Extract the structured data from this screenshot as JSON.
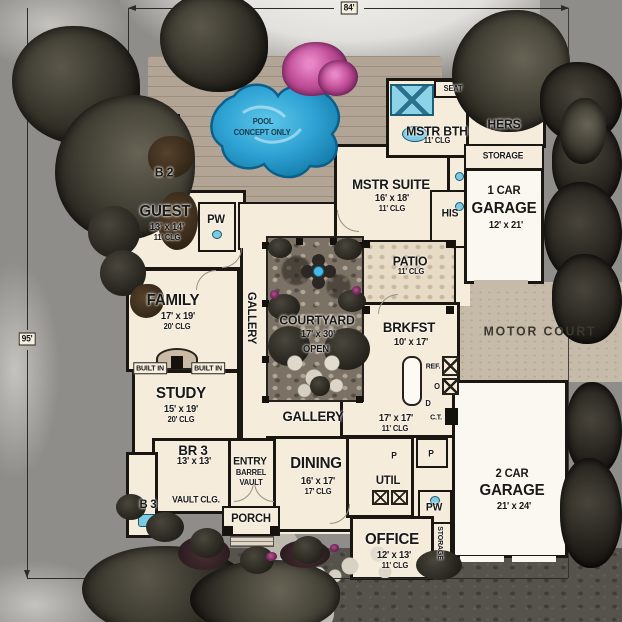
{
  "dims": {
    "width": "84'",
    "height": "95'"
  },
  "pool": {
    "l1": "POOL",
    "l2": "CONCEPT ONLY"
  },
  "rooms": {
    "b2": "B 2",
    "pw1": "PW",
    "pw2": "PW",
    "guest": {
      "name": "GUEST",
      "size": "13' x 14'",
      "clg": "11' CLG"
    },
    "family": {
      "name": "FAMILY",
      "size": "17' x 19'",
      "clg": "20' CLG"
    },
    "builtin_l": "BUILT IN",
    "builtin_r": "BUILT IN",
    "study": {
      "name": "STUDY",
      "size": "15' x 19'",
      "clg": "20' CLG"
    },
    "br3": {
      "name": "BR 3",
      "size": "13' x 13'",
      "clg": "VAULT CLG."
    },
    "b3": "B 3",
    "gallery_left": "GALLERY",
    "gallery_bottom": "GALLERY",
    "entry": {
      "l1": "ENTRY",
      "l2": "BARREL",
      "l3": "VAULT"
    },
    "porch": "PORCH",
    "dining": {
      "name": "DINING",
      "size": "16' x 17'",
      "clg": "17' CLG"
    },
    "util": "UTIL",
    "p1": "P",
    "p2": "P",
    "kitchen": {
      "size": "17' x 17'",
      "clg": "11' CLG"
    },
    "appl": {
      "ref": "REF.",
      "oven": "O",
      "dw": "D",
      "ct": "C.T."
    },
    "brkfst": {
      "name": "BRKFST",
      "size": "10' x 17'"
    },
    "patio": {
      "name": "PATIO",
      "clg": "11' CLG"
    },
    "courtyard": {
      "name": "COURTYARD",
      "size": "17' x 30'",
      "open": "OPEN"
    },
    "mstr_suite": {
      "name": "MSTR SUITE",
      "size": "16' x 18'",
      "clg": "11' CLG"
    },
    "his": "HIS",
    "mstr_bth": {
      "name": "MSTR BTH",
      "clg": "11' CLG"
    },
    "seat": "SEAT",
    "hers": "HERS",
    "storage1": "STORAGE",
    "storage2": "STORAGE",
    "garage1": {
      "l1": "1 CAR",
      "l2": "GARAGE",
      "size": "12' x 21'"
    },
    "garage2": {
      "l1": "2 CAR",
      "l2": "GARAGE",
      "size": "21' x 24'"
    },
    "motor_court": "MOTOR COURT",
    "office": {
      "name": "OFFICE",
      "size": "12' x 13'",
      "clg": "11' CLG"
    }
  },
  "colors": {
    "lawn": "#8e8d89",
    "deck": "#b3a595",
    "house": "#f5ecdc",
    "wall": "#1a1713",
    "pool": "#36a9d9",
    "courtyard": "#7b7164",
    "motor_court": "#c6baa9",
    "driveway": "#56534d",
    "tree": "#39362d",
    "pink_bush": "#c14e99"
  }
}
